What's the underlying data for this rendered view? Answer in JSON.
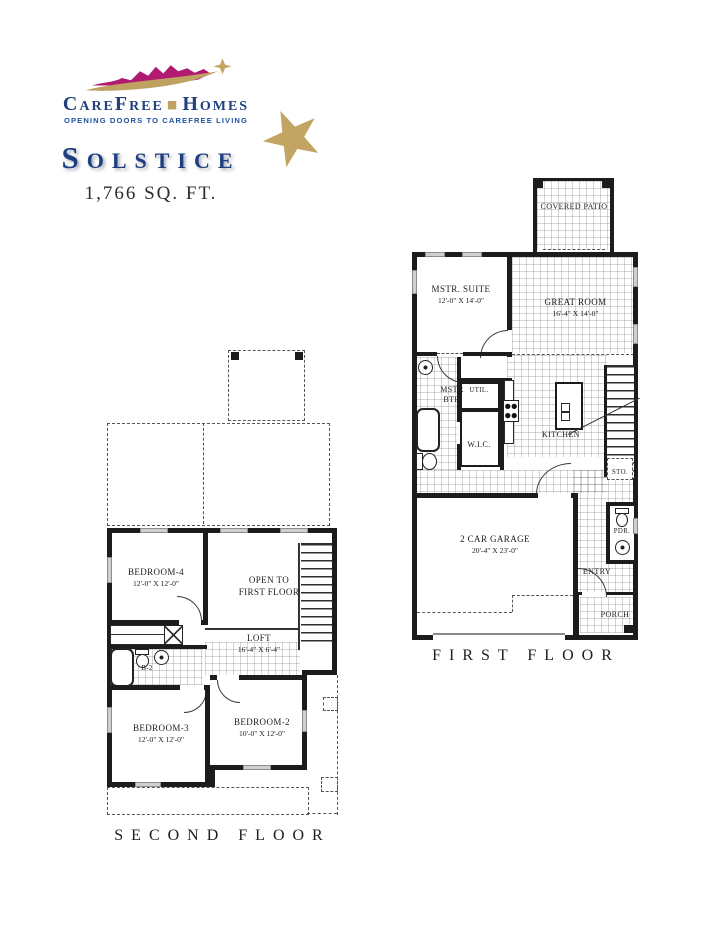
{
  "brand": {
    "word1": "CareFree",
    "separator": "■",
    "word2": "Homes",
    "tagline": "OPENING DOORS TO CAREFREE LIVING"
  },
  "model": {
    "title": "Solstice",
    "sqft": "1,766 SQ. FT."
  },
  "colors": {
    "brand_blue": "#20417e",
    "logo_magenta": "#b01a72",
    "logo_gold": "#c2a463"
  },
  "first_floor": {
    "caption": "FIRST FLOOR",
    "covered_patio": "COVERED PATIO",
    "mstr_suite": "MSTR. SUITE",
    "mstr_suite_dims": "12'-0\" X 14'-0\"",
    "great_room": "GREAT ROOM",
    "great_room_dims": "16'-4\" X 14'-0\"",
    "mstr_bth_line1": "MSTR",
    "mstr_bth_line2": "BTH",
    "util": "UTIL.",
    "wic": "W.I.C.",
    "kitchen": "KITCHEN",
    "sto": "STO.",
    "pdr": "PDR.",
    "entry": "ENTRY",
    "porch": "PORCH",
    "garage": "2 CAR GARAGE",
    "garage_dims": "20'-4\" X 23'-0\""
  },
  "second_floor": {
    "caption": "SECOND FLOOR",
    "bedroom4": "BEDROOM-4",
    "bedroom4_dims": "12'-0\" X 12'-0\"",
    "open_to_line1": "OPEN TO",
    "open_to_line2": "FIRST FLOOR",
    "loft": "LOFT",
    "loft_dims": "16'-4\" X 6'-4\"",
    "b2": "B-2",
    "bedroom3": "BEDROOM-3",
    "bedroom3_dims": "12'-0\" X 12'-0\"",
    "bedroom2": "BEDROOM-2",
    "bedroom2_dims": "10'-0\" X 12'-0\""
  }
}
